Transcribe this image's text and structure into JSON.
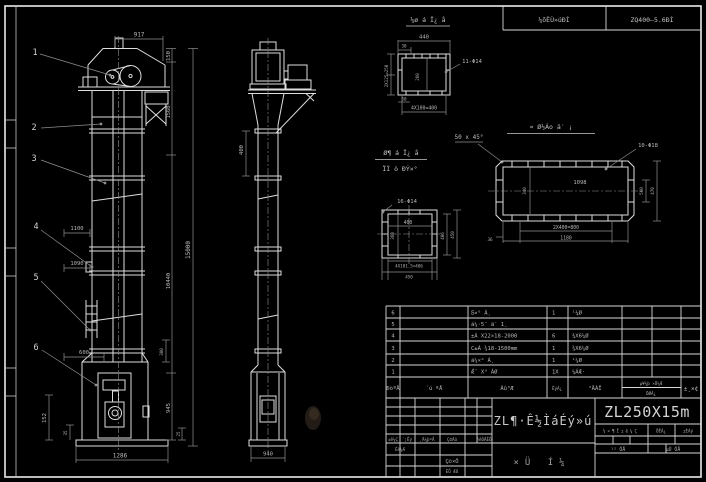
{
  "frame": {
    "header_cell_left": "¼õËÙ»úÐÍ",
    "header_cell_right": "ZQ400—5.6ÐÍ"
  },
  "balloons": [
    "1",
    "2",
    "3",
    "4",
    "5",
    "6"
  ],
  "front": {
    "d_top": "917",
    "d_r1": "150",
    "d_r2": "1560",
    "d_r3": "10440",
    "d_r4": "945",
    "d_r5": "25",
    "d_r6": "380",
    "d_total": "15000",
    "d_l1": "1100",
    "d_l2": "1090",
    "d_l3": "600",
    "d_l4": "152",
    "d_l5": "35",
    "d_bottom": "1286"
  },
  "side": {
    "d_flange": "400",
    "d_base": "940"
  },
  "channel": {
    "label": "¼ø á Ï¿ å",
    "d_top": "440",
    "d_off": "30",
    "d_left": "2X125=250",
    "d_in": "260",
    "d_b1": "50",
    "d_b2": "4X100=400",
    "holes": "11-Φ14"
  },
  "chamfer_note": "50 x 45°",
  "midlabel": {
    "l1": "Ø¶ á Ï¿ å",
    "l2": "ÏÌ ò ÐÝ×°"
  },
  "flange": {
    "label": "¤ Ø½Áo ä′ ¡",
    "holes": "10-Φ18",
    "d_in": "1098",
    "d_left": "340",
    "d_r1": "560",
    "d_r2": "470",
    "d_b1": "2X400=800",
    "d_b2": "1180",
    "d_c": "36"
  },
  "square": {
    "holes": "16-Φ14",
    "d_h": "400",
    "d_v": "360",
    "d_r1": "406",
    "d_r2": "450",
    "d_b1": "4X101.5=406",
    "d_b2": "450"
  },
  "parts": {
    "headers": {
      "no": "ÐòºÅ",
      "code": "´ú ºÅ",
      "name": "Ãû³Æ",
      "qty": "ÊýÁ¿",
      "material": "²ÄÁÏ",
      "note_top": "µ¥¼þ ×Ü¼Æ",
      "note_bottom": "ÖØÁ¿",
      "remark": "±¸×¢"
    },
    "rows": [
      {
        "no": "6",
        "code": "",
        "name": "Ƽ×° Á¸",
        "qty": "1",
        "mat": "¹¼Ø"
      },
      {
        "no": "5",
        "code": "",
        "name": "á¼·5¨ ä′ 1¸",
        "qty": "",
        "mat": ""
      },
      {
        "no": "4",
        "code": "",
        "name": "±Á X22×18-2000",
        "qty": "6",
        "mat": "¾X6¼Ø"
      },
      {
        "no": "3",
        "code": "",
        "name": "C±Á ¾18-1500mm",
        "qty": "1",
        "mat": "¾X6¼Ø"
      },
      {
        "no": "2",
        "code": "",
        "name": "á¼×° Á¸",
        "qty": "1",
        "mat": "¹¼Ø"
      },
      {
        "no": "1",
        "code": "",
        "name": "Ǽ¨ X° ÁØ",
        "qty": "1X",
        "mat": "¼ÁÆ·"
      }
    ]
  },
  "titleblock": {
    "rev_c1": "±ê¼Ç",
    "rev_c2": "´¦Êý",
    "rev_c3": "¸Ä¼þºÅ",
    "rev_c4": "Ç©Ãû",
    "rev_c5": "ÄêÔÂÈÕ",
    "design": "Éè¼Æ",
    "stamp": "Ç©×Ö",
    "date": "ÈÕ ÆÚ",
    "title": "ZL¶·Ê½ÌáÉý»ú",
    "sheet_type": "×Ü Í¼",
    "model": "ZL250X15m",
    "stage_c1": "½×¶Î±ê¼Ç",
    "stage_c2": "ÖÊÁ¿",
    "stage_c3": "±ÈÀý",
    "sheets_left": "¹² ÕÅ",
    "sheets_right": "µÚ ÕÅ"
  }
}
